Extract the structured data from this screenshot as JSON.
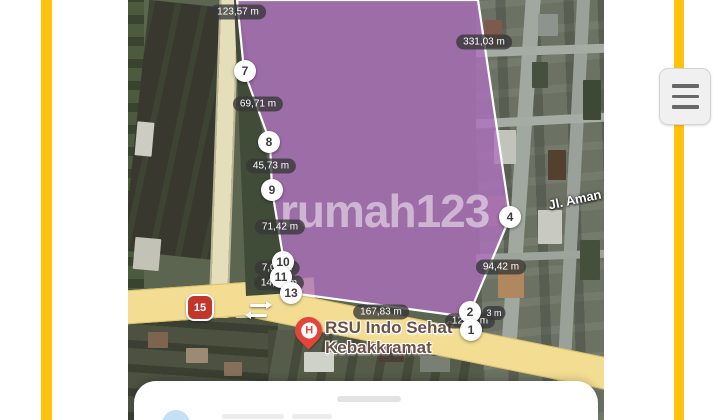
{
  "theme": {
    "accent_yellow": "#ffc20e",
    "road_main": "#f2dd92",
    "parcel_fill": "#b06fc0",
    "parcel_fill_opacity": "0.78",
    "parcel_stroke": "#ffffff",
    "bubble_bg": "rgba(55,55,55,0.78)"
  },
  "map": {
    "watermark": "rumah123",
    "street_label": "Jl. Aman",
    "route_shield": "15",
    "poi": {
      "icon": "hospital-pin",
      "icon_letter": "H",
      "name_line1": "RSU Indo Sehat",
      "name_line2": "Kebakkramat"
    },
    "parcel": {
      "points": "109,0 116,71 142,142 144,190 156,262 153,277 163,293 340,317 382,217 375,170 350,0"
    },
    "markers": [
      {
        "label": "7",
        "x": 245,
        "y": 71
      },
      {
        "label": "8",
        "x": 269,
        "y": 142
      },
      {
        "label": "9",
        "x": 272,
        "y": 190
      },
      {
        "label": "10",
        "x": 283,
        "y": 262
      },
      {
        "label": "11",
        "x": 281,
        "y": 277
      },
      {
        "label": "13",
        "x": 291,
        "y": 293
      },
      {
        "label": "4",
        "x": 510,
        "y": 217
      },
      {
        "label": "2",
        "x": 470,
        "y": 312
      },
      {
        "label": "1",
        "x": 471,
        "y": 330
      }
    ],
    "distance_labels": [
      {
        "text": "123,57 m",
        "x": 238,
        "y": 12
      },
      {
        "text": "69,71 m",
        "x": 258,
        "y": 104
      },
      {
        "text": "45,73 m",
        "x": 271,
        "y": 166
      },
      {
        "text": "71,42 m",
        "x": 280,
        "y": 227
      },
      {
        "text": "331,03 m",
        "x": 484,
        "y": 42
      },
      {
        "text": "94,42 m",
        "x": 501,
        "y": 267
      },
      {
        "text": "167,83 m",
        "x": 381,
        "y": 312
      },
      {
        "text": "7,08 m",
        "x": 277,
        "y": 268,
        "behind": true
      },
      {
        "text": "14,43 m",
        "x": 279,
        "y": 283,
        "behind": true
      },
      {
        "text": "12,43 m",
        "x": 470,
        "y": 321,
        "behind": true
      },
      {
        "text": "3 m",
        "x": 494,
        "y": 313,
        "small": true
      }
    ]
  },
  "side_menu": {
    "icon": "hamburger"
  },
  "bottom_sheet": {
    "has_handle": true
  }
}
